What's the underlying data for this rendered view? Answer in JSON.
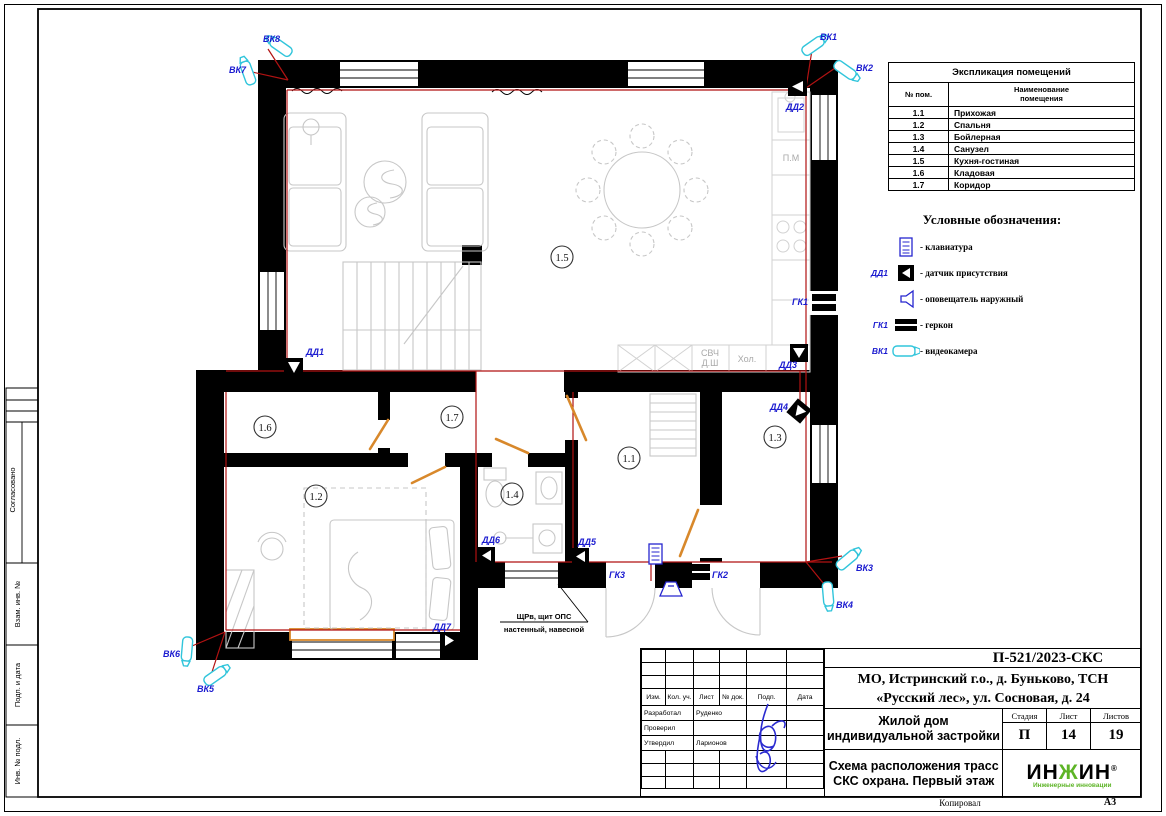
{
  "explication": {
    "title": "Экспликация помещений",
    "col_num": "№ пом.",
    "col_name": "Наименование помещения",
    "rows": [
      {
        "num": "1.1",
        "name": "Прихожая"
      },
      {
        "num": "1.2",
        "name": "Спальня"
      },
      {
        "num": "1.3",
        "name": "Бойлерная"
      },
      {
        "num": "1.4",
        "name": "Санузел"
      },
      {
        "num": "1.5",
        "name": "Кухня-гостиная"
      },
      {
        "num": "1.6",
        "name": "Кладовая"
      },
      {
        "num": "1.7",
        "name": "Коридор"
      }
    ]
  },
  "legend": {
    "title": "Условные обозначения:",
    "items": [
      {
        "icon": "keypad-icon",
        "prefix": "",
        "label": "- клавиатура"
      },
      {
        "icon": "presence-sensor-icon",
        "prefix": "ДД1",
        "label": "- датчик присутствия"
      },
      {
        "icon": "outdoor-sounder-icon",
        "prefix": "",
        "label": "- оповещатель наружный"
      },
      {
        "icon": "reed-switch-icon",
        "prefix": "ГК1",
        "label": "- геркон"
      },
      {
        "icon": "camera-icon",
        "prefix": "ВК1",
        "label": "- видеокамера"
      }
    ]
  },
  "title_block": {
    "doc_code": "П-521/2023-СКС",
    "address_line1": "МО, Истринский г.о., д. Буньково, ТСН",
    "address_line2": "«Русский лес», ул. Сосновая, д. 24",
    "object_name": "Жилой дом индивидуальной застройки",
    "drawing_title": "Схема расположения трасс СКС охрана. Первый этаж",
    "stage_label": "Стадия",
    "stage": "П",
    "sheet_label": "Лист",
    "sheet": "14",
    "sheets_label": "Листов",
    "sheets": "19",
    "header_cols": [
      "Изм.",
      "Кол. уч.",
      "Лист",
      "№ док.",
      "Подп.",
      "Дата"
    ],
    "roles": [
      {
        "role": "Разработал",
        "name": "Руденко"
      },
      {
        "role": "Проверил",
        "name": ""
      },
      {
        "role": "Утвердил",
        "name": "Ларионов"
      }
    ],
    "logo": {
      "p1": "ИН",
      "p2": "Ж",
      "p3": "ИН",
      "reg": "®",
      "subtitle": "Инженерные инновации"
    }
  },
  "margin": {
    "agreed": "Согласовано",
    "vzam": "Взам. инв. №",
    "podp": "Подп. и дата",
    "inv": "Инв. № подл."
  },
  "footer": {
    "copied": "Копировал",
    "format": "А3"
  },
  "plan": {
    "room_numbers": {
      "r11": "1.1",
      "r12": "1.2",
      "r13": "1.3",
      "r14": "1.4",
      "r15": "1.5",
      "r16": "1.6",
      "r17": "1.7"
    },
    "device_labels": {
      "vk1": "ВК1",
      "vk2": "ВК2",
      "vk3": "ВК3",
      "vk4": "ВК4",
      "vk5": "ВК5",
      "vk6": "ВК6",
      "vk7": "ВК7",
      "vk8": "ВК8",
      "dd1": "ДД1",
      "dd2": "ДД2",
      "dd3": "ДД3",
      "dd4": "ДД4",
      "dd5": "ДД5",
      "dd6": "ДД6",
      "dd7": "ДД7",
      "gk1": "ГК1",
      "gk2": "ГК2",
      "gk3": "ГК3"
    },
    "appliance_labels": {
      "svch": "СВЧ",
      "dsh": "Д.Ш",
      "hol": "Хол.",
      "pm": "П.М"
    },
    "callout": {
      "line1": "ЩРв, щит ОПС",
      "line2": "настенный, навесной"
    }
  },
  "colors": {
    "wall": "#000000",
    "cable_route": "#b11212",
    "door": "#d8882b",
    "device_label": "#1b1bd0",
    "camera": "#31c5db",
    "furniture": "#c7c7c7",
    "logo_green": "#5db426"
  }
}
